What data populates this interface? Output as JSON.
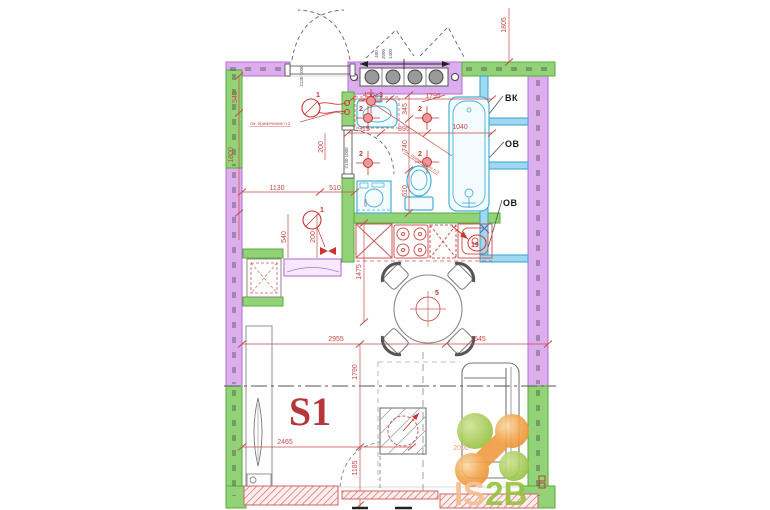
{
  "plan": {
    "apartment": "S1",
    "shafts": {
      "vk": "ВК",
      "ov1": "ОВ",
      "ov2": "ОВ"
    },
    "dims": {
      "d540a": "540",
      "d1800": "1800",
      "d1805": "1805",
      "d1130": "1130",
      "d510": "510",
      "d540b": "540",
      "d200a": "200",
      "d200b": "200",
      "d456": "456",
      "d1795": "1795",
      "d315": "315",
      "d895": "895",
      "d1040": "1040",
      "d345": "345",
      "d740": "740",
      "d610": "610",
      "d600": "600",
      "d1475": "1475",
      "d2955": "2955",
      "d1545": "1545",
      "d1790": "1790",
      "d2465": "2465",
      "d1185": "1185",
      "d2000": "2000",
      "door_a": "2130 1000",
      "door_b": "2130 1000",
      "win_a": "400",
      "win_b": "2000",
      "win_c": "1400"
    },
    "tags": {
      "t1a": "1",
      "t1b": "1",
      "t2a": "2",
      "t2b": "2",
      "t2c": "2",
      "t2d": "2",
      "t3": "3",
      "t5": "5",
      "t19": "19"
    },
    "notes": {
      "note2": "см. примечание п.2",
      "note3": "см. примечание п.3"
    },
    "colors": {
      "wall_purple": "#dcaeee",
      "wall_green": "#93d377",
      "shaft_cyan": "#9fd8ef",
      "dimension_red": "#c64a4a",
      "logo_orange": "#f09b3f",
      "logo_green": "#97c23c"
    }
  },
  "logo": {
    "part1": "IS",
    "part2": "2B"
  }
}
